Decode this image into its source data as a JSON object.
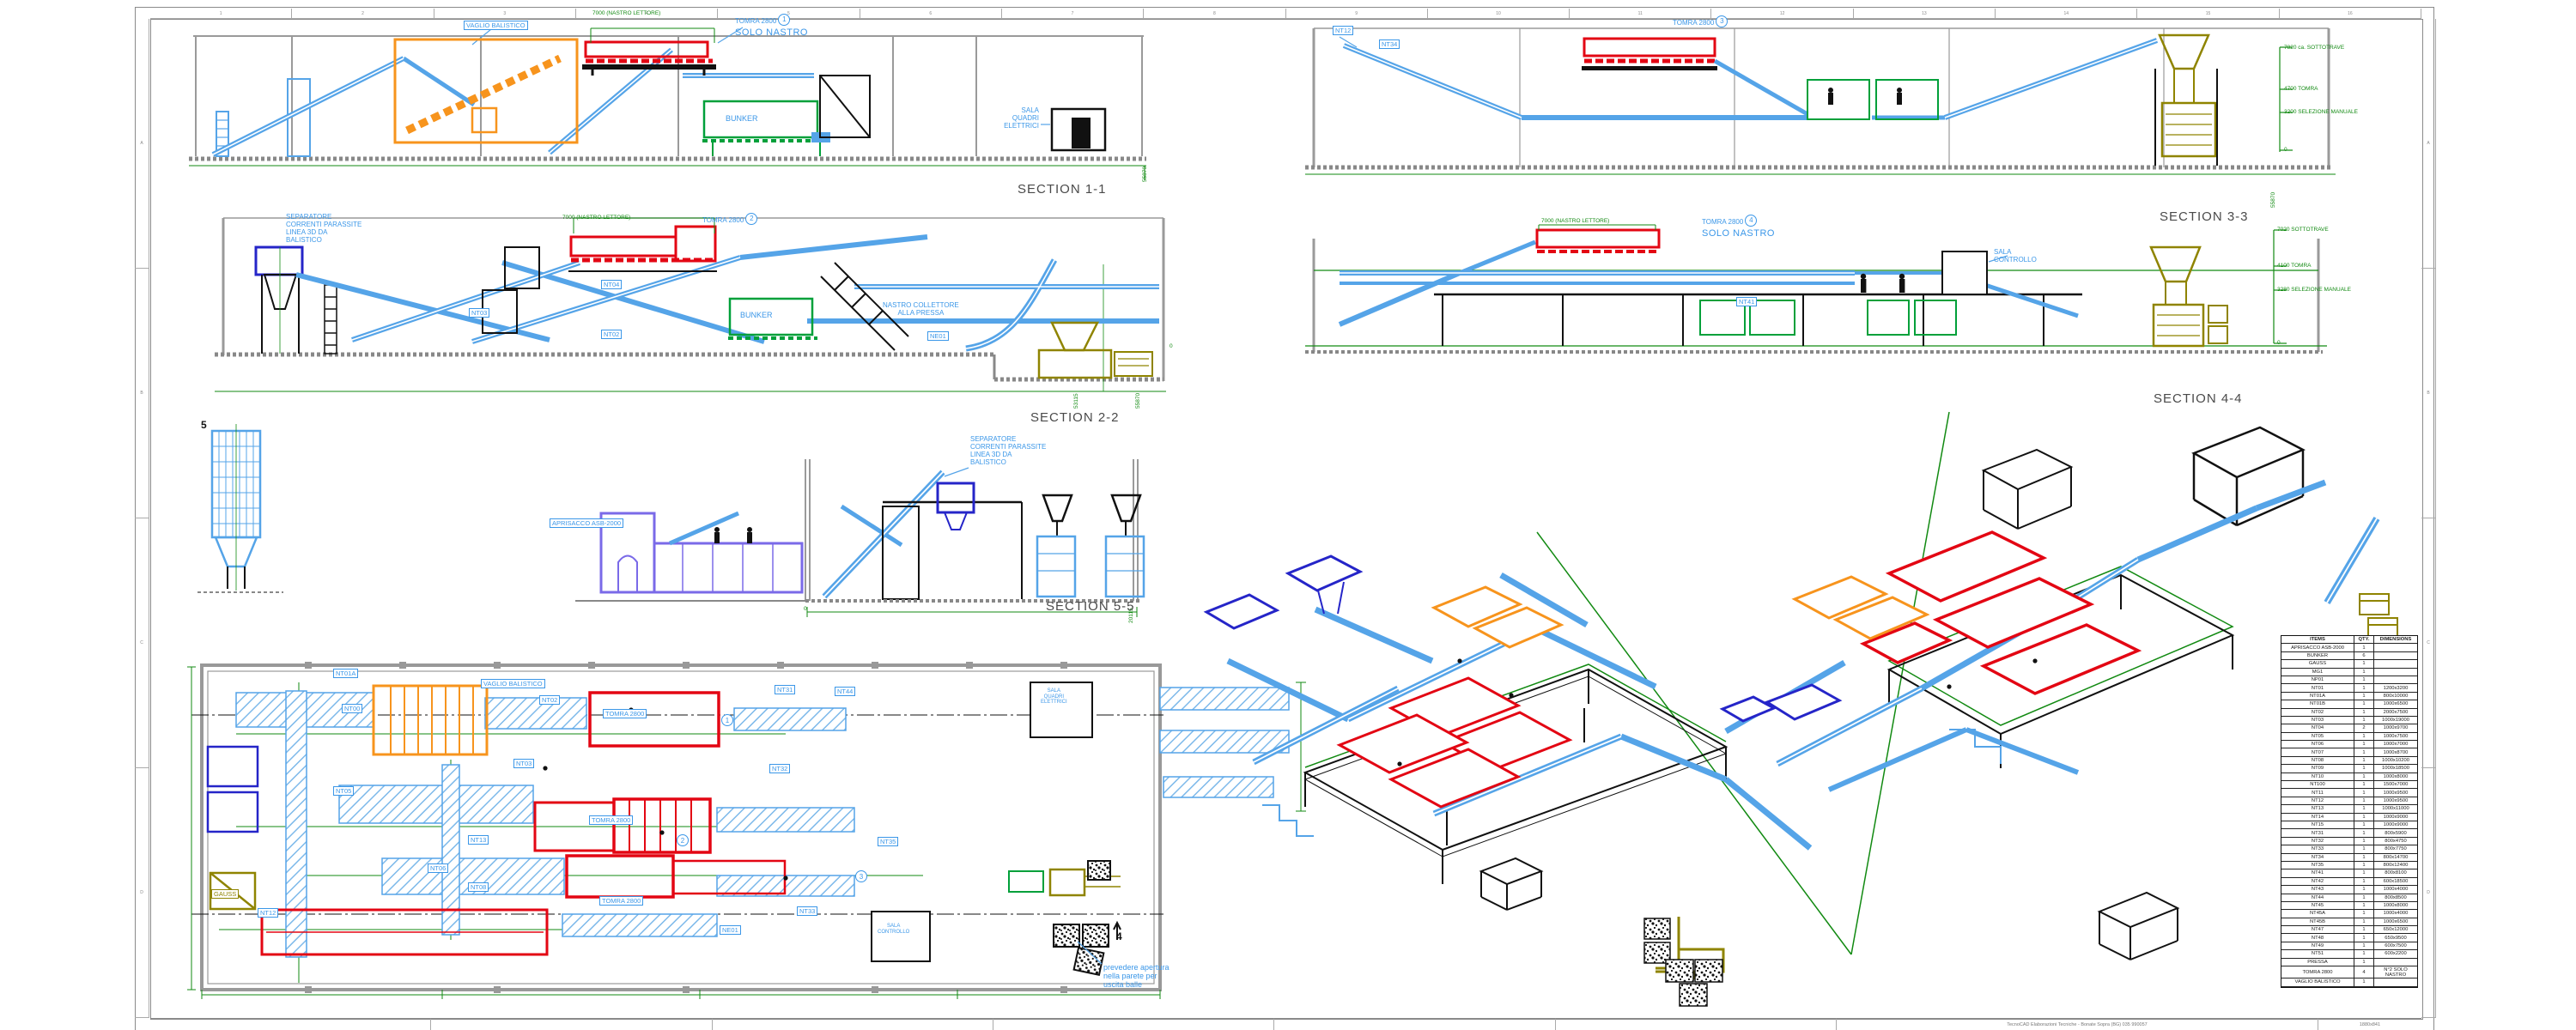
{
  "sheet": {
    "ruler_numbers": [
      "1",
      "2",
      "3",
      "4",
      "5",
      "6",
      "7",
      "8",
      "9",
      "10",
      "11",
      "12",
      "13",
      "14",
      "15",
      "16"
    ],
    "ruler_letters": [
      "A",
      "B",
      "C",
      "D"
    ],
    "footer_company": "TecnoCAD Elaborazioni Tecniche - Bonate Sopra (BG) 035 990057",
    "footer_size": "1880x841"
  },
  "sections": {
    "s11": {
      "title": "SECTION 1-1",
      "vaglio": "VAGLIO BALISTICO",
      "tomra": "TOMRA 2800",
      "tomra_no": "1",
      "tomra_sub": "SOLO NASTRO",
      "dim_top": "7000 (NASTRO LETTORE)",
      "bunker": "BUNKER",
      "sala": "SALA\nQUADRI\nELETTRICI",
      "dim_right": "55870"
    },
    "s22": {
      "title": "SECTION 2-2",
      "sep": "SEPARATORE\nCORRENTI PARASSITE\nLINEA 3D DA\nBALISTICO",
      "dim_top": "7000 (NASTRO LETTORE)",
      "tomra": "TOMRA 2800",
      "tomra_no": "2",
      "bunker": "BUNKER",
      "nastro": "NASTRO COLLETTORE\nALLA PRESSA",
      "tag_ne01": "NE01",
      "tag_nt03": "NT03",
      "tag_nt04": "NT04",
      "tag_nt02": "NT02",
      "dim_a": "53115",
      "dim_b": "55870",
      "dim_zero": "0"
    },
    "s33": {
      "title": "SECTION 3-3",
      "tomra": "TOMRA 2800",
      "tomra_no": "3",
      "tag_a": "NT12",
      "tag_b": "NT34",
      "dims": [
        "7820 ca. SOTTOTRAVE",
        "4700 TOMRA",
        "3200 SELEZIONE MANUALE",
        "0"
      ],
      "dim_right": "55870"
    },
    "s44": {
      "title": "SECTION 4-4",
      "tomra": "TOMRA 2800",
      "tomra_no": "4",
      "tomra_sub": "SOLO NASTRO",
      "dim_top": "7000 (NASTRO LETTORE)",
      "sala": "SALA\nCONTROLLO",
      "tag_nt41": "NT41",
      "dims": [
        "7020 SOTTOTRAVE",
        "4100 TOMRA",
        "3280 SELEZIONE MANUALE",
        "0"
      ]
    },
    "s55": {
      "title": "SECTION 5-5",
      "apri": "APRISACCO ASB-2000",
      "sep": "SEPARATORE\nCORRENTI PARASSITE\nLINEA 3D DA\nBALISTICO",
      "dim_zero": "0",
      "dim_right": "20115"
    }
  },
  "plan": {
    "vaglio": "VAGLIO BALISTICO",
    "tomra1": "TOMRA 2800",
    "no1": "1",
    "tomra2": "TOMRA 2800",
    "no2": "2",
    "tomra3": "TOMRA 2800",
    "no3": "3",
    "gauss": "GAUSS",
    "sala_quadri": "SALA\nQUADRI\nELETTRICI",
    "sala_controllo": "SALA\nCONTROLLO",
    "note": "prevedere apertura\nnella parete per\nuscita balle",
    "marker4": "4",
    "marker5": "5",
    "tags": [
      "NT01A",
      "NT00",
      "NT02",
      "NT03",
      "NT05",
      "NT06",
      "NT13",
      "NT31",
      "NT32",
      "NT33",
      "NT35",
      "NT44",
      "NE01",
      "NT08",
      "NT12"
    ]
  },
  "table": {
    "headers": [
      "ITEMS",
      "QTY.",
      "DIMENSIONS"
    ],
    "rows": [
      {
        "item": "APRISACCO ASB-2000",
        "qty": "1",
        "dim": ""
      },
      {
        "item": "BUNKER",
        "qty": "6",
        "dim": ""
      },
      {
        "item": "GAUSS",
        "qty": "1",
        "dim": ""
      },
      {
        "item": "MG1",
        "qty": "1",
        "dim": ""
      },
      {
        "item": "NP01",
        "qty": "1",
        "dim": ""
      },
      {
        "item": "NT01",
        "qty": "1",
        "dim": "1200x3200"
      },
      {
        "item": "NT01A",
        "qty": "1",
        "dim": "800x10000"
      },
      {
        "item": "NT01B",
        "qty": "1",
        "dim": "1000x6500"
      },
      {
        "item": "NT02",
        "qty": "1",
        "dim": "2000x7500"
      },
      {
        "item": "NT03",
        "qty": "1",
        "dim": "1000x19000"
      },
      {
        "item": "NT04",
        "qty": "2",
        "dim": "1000x9700"
      },
      {
        "item": "NT05",
        "qty": "1",
        "dim": "1000x7500"
      },
      {
        "item": "NT06",
        "qty": "1",
        "dim": "1000x7000"
      },
      {
        "item": "NT07",
        "qty": "1",
        "dim": "1000x8700"
      },
      {
        "item": "NT08",
        "qty": "1",
        "dim": "1000x10200"
      },
      {
        "item": "NT09",
        "qty": "1",
        "dim": "1000x18500"
      },
      {
        "item": "NT10",
        "qty": "1",
        "dim": "1000x8000"
      },
      {
        "item": "NT100",
        "qty": "1",
        "dim": "1500x7000"
      },
      {
        "item": "NT11",
        "qty": "1",
        "dim": "1000x9500"
      },
      {
        "item": "NT12",
        "qty": "1",
        "dim": "1000x9500"
      },
      {
        "item": "NT13",
        "qty": "1",
        "dim": "1000x11000"
      },
      {
        "item": "NT14",
        "qty": "1",
        "dim": "1000x9000"
      },
      {
        "item": "NT15",
        "qty": "1",
        "dim": "1000x9000"
      },
      {
        "item": "NT31",
        "qty": "1",
        "dim": "800x5900"
      },
      {
        "item": "NT32",
        "qty": "1",
        "dim": "800x4750"
      },
      {
        "item": "NT33",
        "qty": "1",
        "dim": "800x7750"
      },
      {
        "item": "NT34",
        "qty": "1",
        "dim": "800x14700"
      },
      {
        "item": "NT35",
        "qty": "1",
        "dim": "800x12400"
      },
      {
        "item": "NT41",
        "qty": "1",
        "dim": "800x8100"
      },
      {
        "item": "NT42",
        "qty": "1",
        "dim": "600x18500"
      },
      {
        "item": "NT43",
        "qty": "1",
        "dim": "1000x4000"
      },
      {
        "item": "NT44",
        "qty": "1",
        "dim": "800x8500"
      },
      {
        "item": "NT45",
        "qty": "1",
        "dim": "1000x8000"
      },
      {
        "item": "NT45A",
        "qty": "1",
        "dim": "1000x4000"
      },
      {
        "item": "NT45B",
        "qty": "1",
        "dim": "1000x6500"
      },
      {
        "item": "NT47",
        "qty": "1",
        "dim": "650x12000"
      },
      {
        "item": "NT48",
        "qty": "1",
        "dim": "650x9500"
      },
      {
        "item": "NT49",
        "qty": "1",
        "dim": "600x7500"
      },
      {
        "item": "NT51",
        "qty": "1",
        "dim": "600x2200"
      },
      {
        "item": "PRESSA",
        "qty": "1",
        "dim": ""
      },
      {
        "item": "TOMRA 2800",
        "qty": "4",
        "dim": "N°2 SOLO NASTRO"
      },
      {
        "item": "VAGLIO BALISTICO",
        "qty": "1",
        "dim": ""
      }
    ]
  }
}
